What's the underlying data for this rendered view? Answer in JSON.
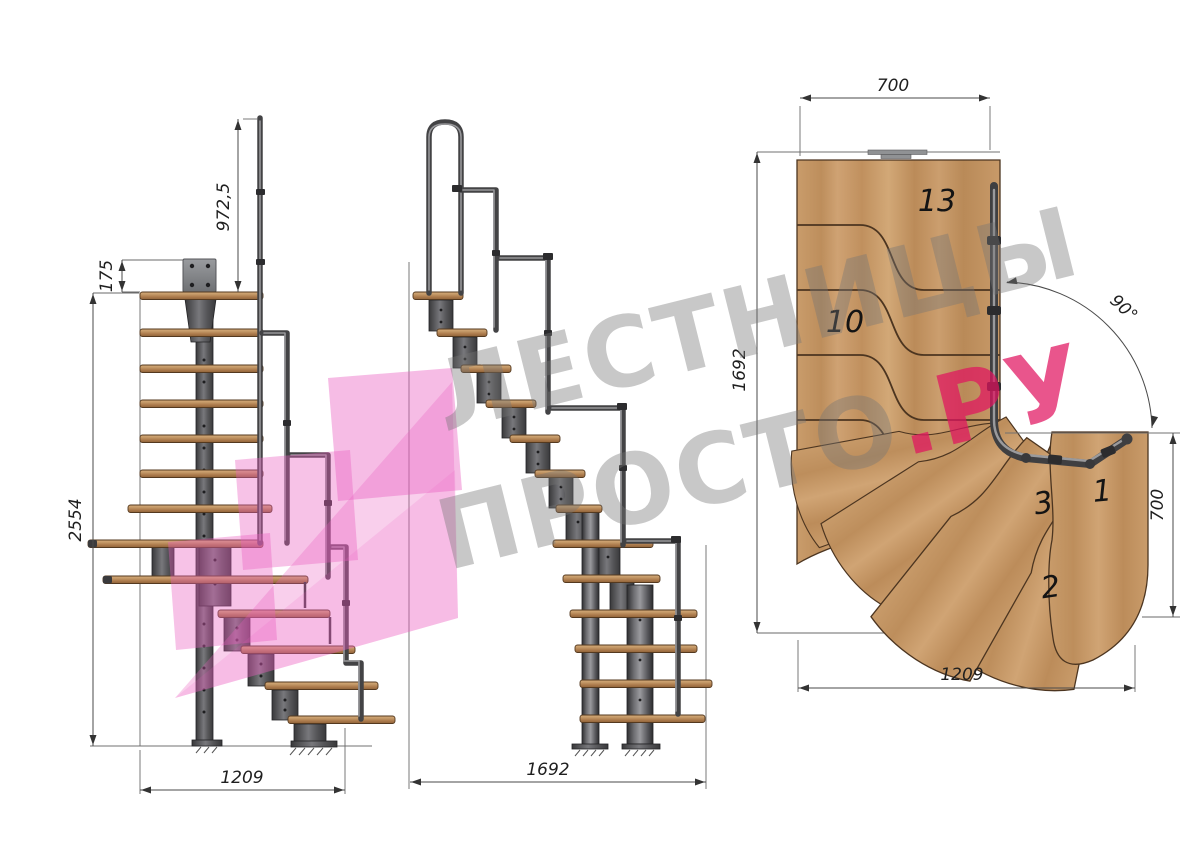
{
  "watermark": {
    "line1": "ЛЕСТНИЦЫ",
    "line2": "ПРОСТО",
    "accent": ".РУ"
  },
  "side_view": {
    "dim_rail_height": "972,5",
    "dim_plate_offset": "175",
    "dim_total_height": "2554",
    "dim_run": "1209"
  },
  "front_view": {
    "dim_run": "1692"
  },
  "plan_view": {
    "dim_top_width": "700",
    "dim_left_height": "1692",
    "dim_right_depth": "700",
    "dim_bottom_width": "1209",
    "dim_turn_angle": "90°",
    "steps": {
      "s13": "13",
      "s10": "10",
      "s3": "3",
      "s1": "1",
      "s2": "2"
    }
  },
  "colors": {
    "accent_pink": "#e54e8b",
    "logo_pink": "#ea5fc0",
    "wood": "#c1925f",
    "metal": "#4a4a4c",
    "dim_line": "#4a4a4a",
    "watermark_gray": "#9a9a9a"
  }
}
